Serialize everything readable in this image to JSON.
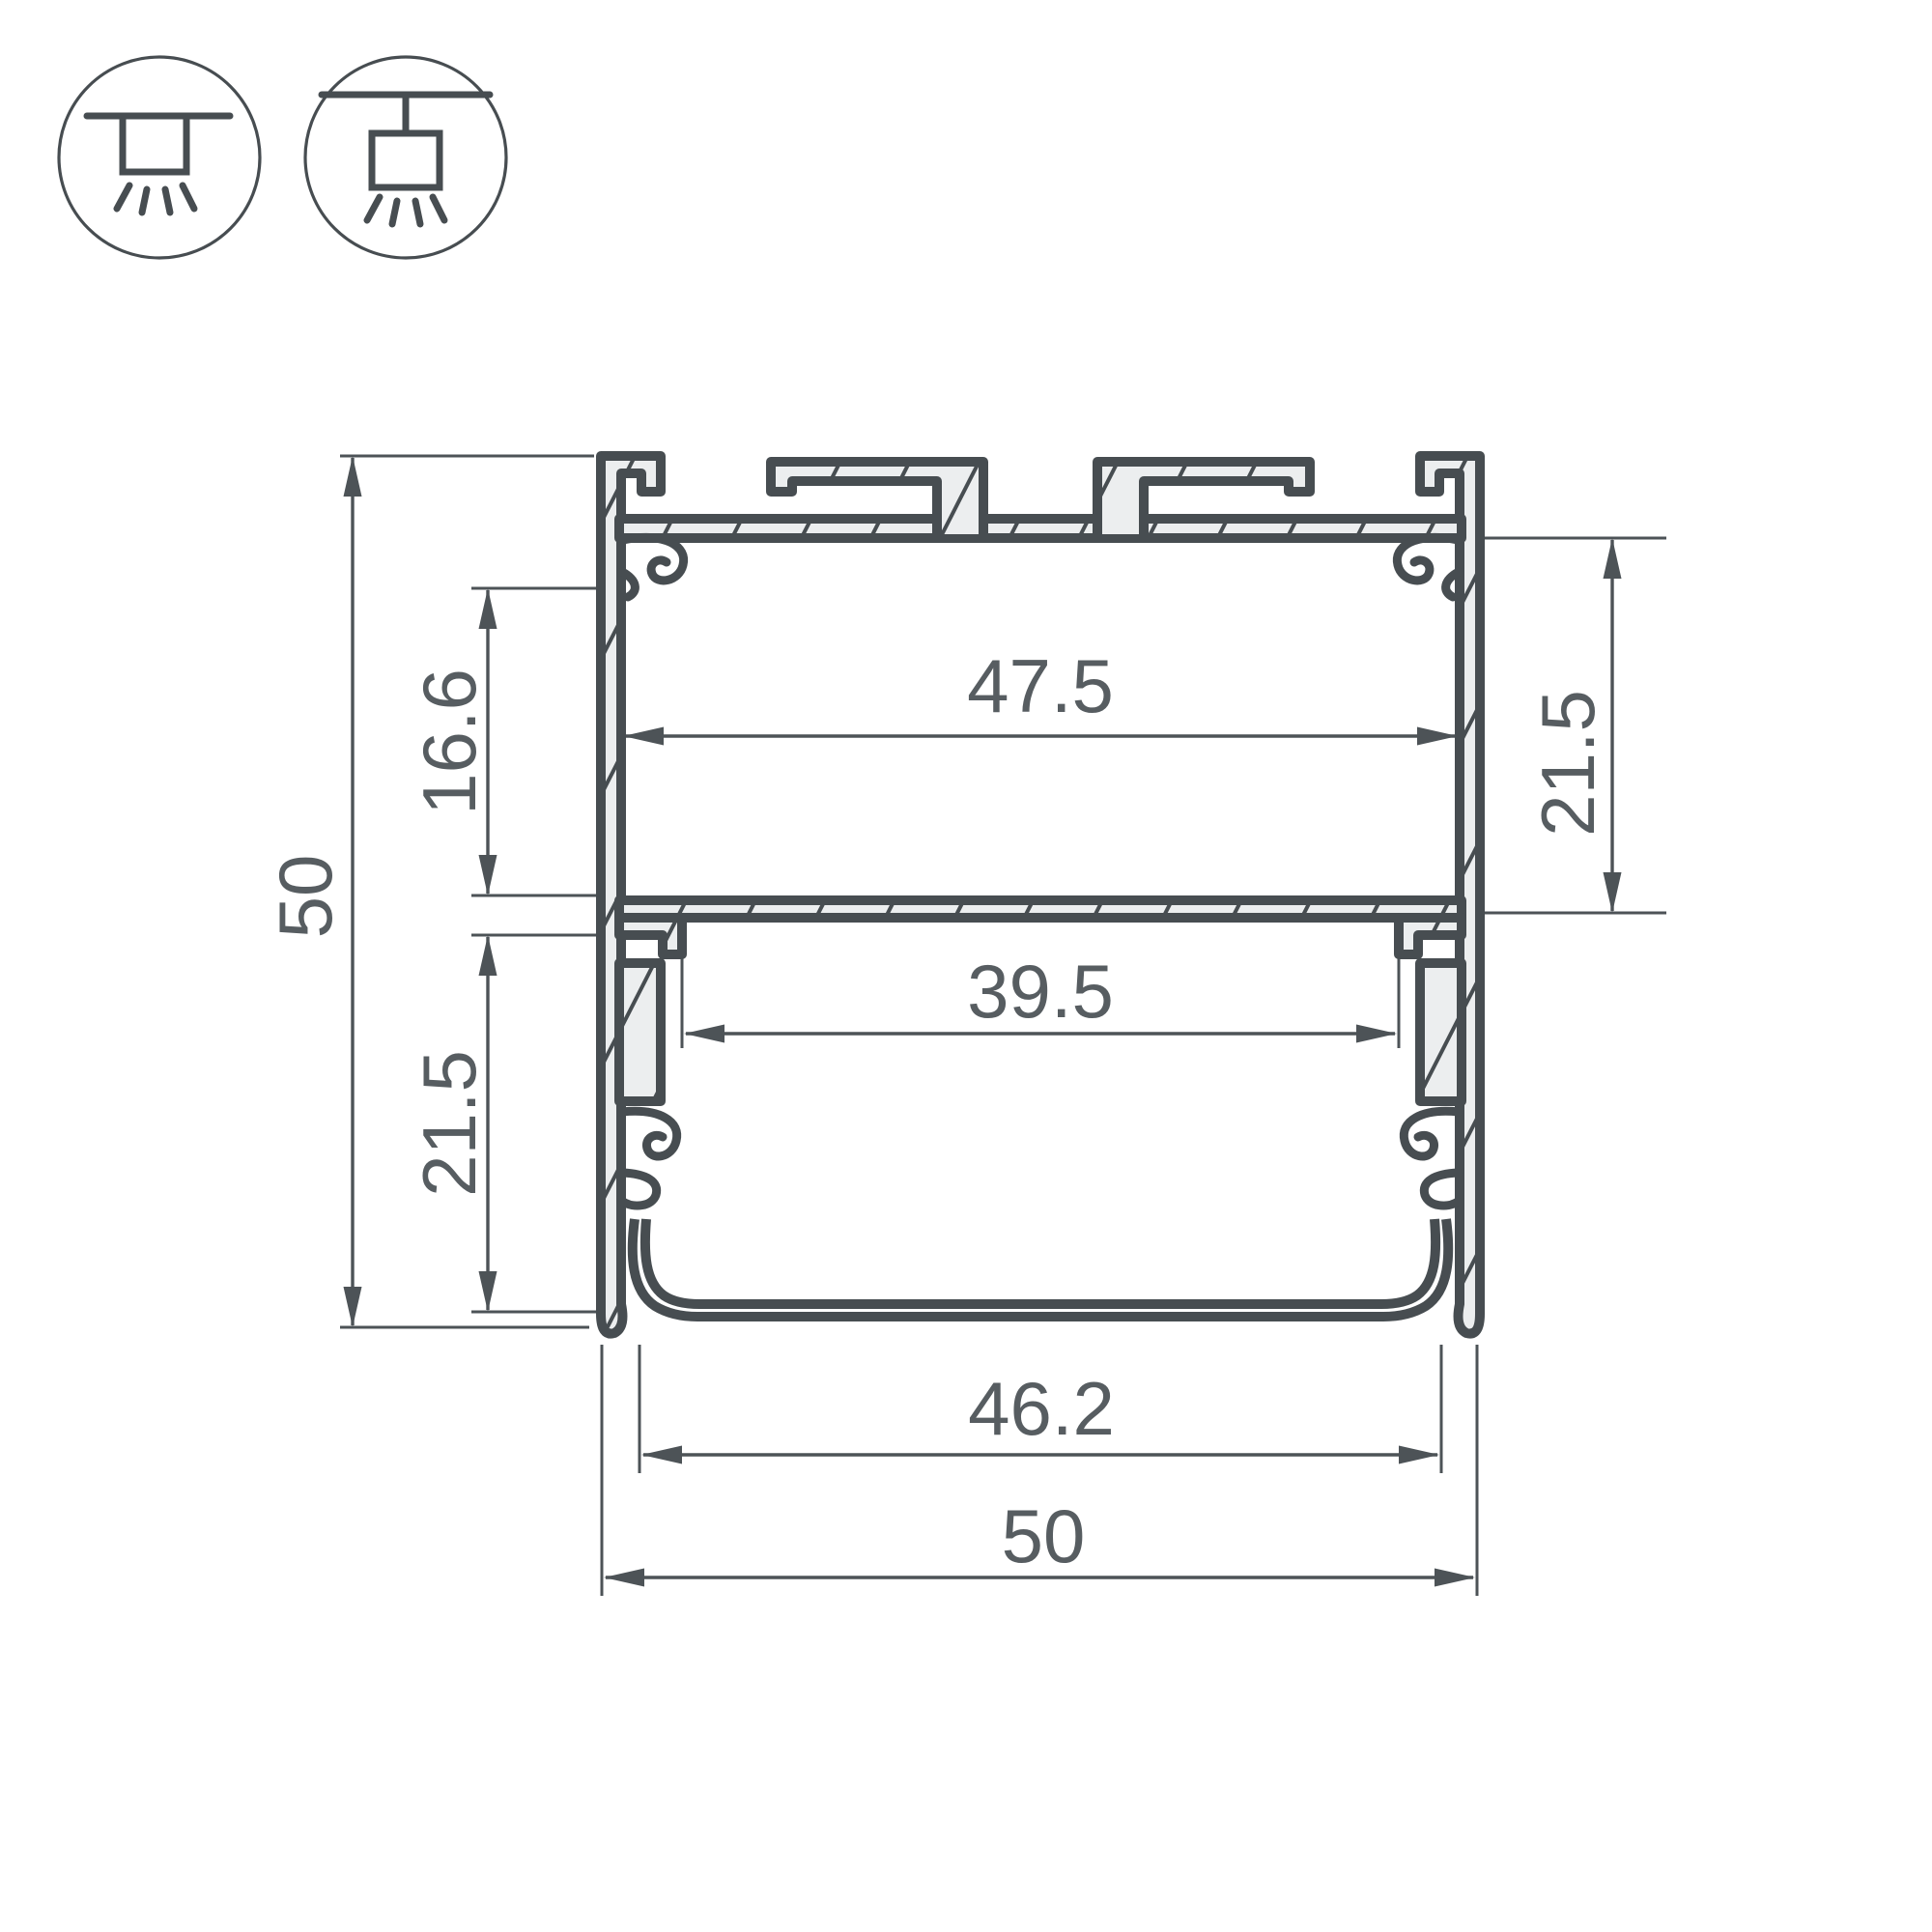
{
  "icons": {
    "recessed": "recessed-mount-icon",
    "pendant": "pendant-mount-icon"
  },
  "dimensions": {
    "overall_height": "50",
    "upper_pocket_height": "16.6",
    "lower_pocket_height": "21.5",
    "inner_width_top": "47.5",
    "side_pocket_height": "21.5",
    "inner_width_bottom": "39.5",
    "diffuser_width": "46.2",
    "overall_width": "50"
  },
  "colors": {
    "line": "#474d51",
    "dimension": "#4d5357",
    "text": "#575d61",
    "metal_fill": "#eceeef",
    "background": "#ffffff"
  }
}
